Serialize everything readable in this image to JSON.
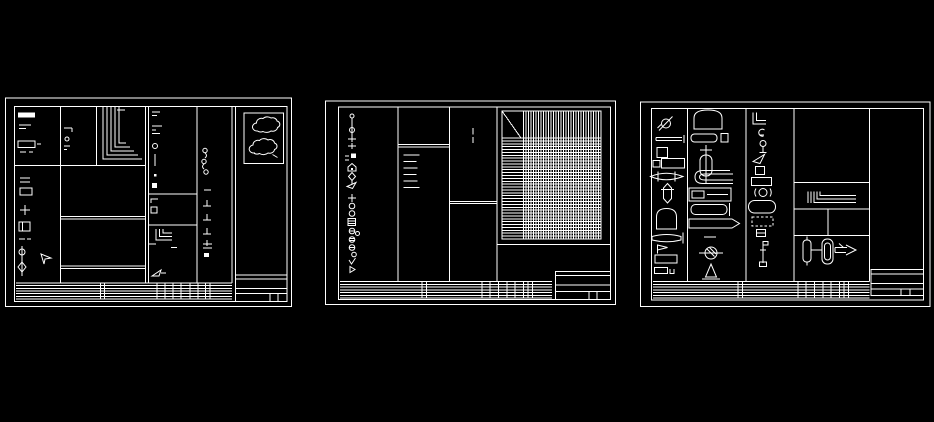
{
  "colors": {
    "background": "#000000",
    "line": "#ffffff"
  },
  "canvas": {
    "kind": "cad-model-space",
    "width": 934,
    "height": 422
  },
  "sheets": [
    {
      "label": "sheet-1",
      "description": "drawing frame with legend column, nested angle detail, revision clouds and title block"
    },
    {
      "label": "sheet-2",
      "description": "drawing frame with symbol legend column and hatched schedule grid"
    },
    {
      "label": "sheet-3",
      "description": "symbol library sheet with fixture block columns and title block"
    }
  ],
  "tables": {
    "sheet1_strip": {
      "x0": 16,
      "x1": 232,
      "y0": 283,
      "y1": 299,
      "rows": 6,
      "verticals": [
        100.5,
        104.5,
        157,
        165,
        173,
        181,
        190,
        198,
        205.5,
        210
      ]
    },
    "sheet2_strip": {
      "x0": 340,
      "x1": 552,
      "y0": 281.5,
      "y1": 298,
      "rows": 6,
      "verticals": [
        422,
        426.5,
        482,
        490,
        498.5,
        507,
        515,
        523.5,
        528,
        532.5
      ]
    },
    "sheet3_strip": {
      "x0": 653,
      "x1": 869.5,
      "y0": 281.5,
      "y1": 298,
      "rows": 6,
      "verticals": [
        738,
        742.5,
        798,
        806,
        814.5,
        823,
        831,
        839.5,
        844,
        848.5
      ]
    },
    "sheet2_grid": {
      "x": 502,
      "y": 111,
      "w": 99,
      "h": 128,
      "header_h": 27,
      "stub_w": 19,
      "cols": 31,
      "rows": 34,
      "diagonal": true
    }
  }
}
